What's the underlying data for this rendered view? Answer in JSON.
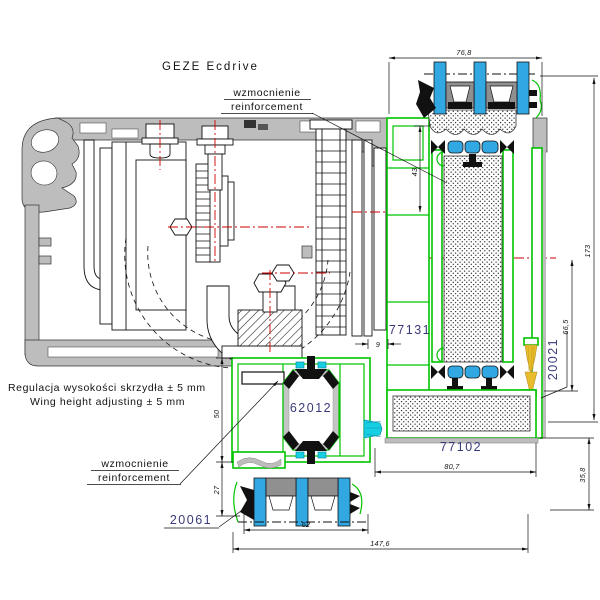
{
  "title": "GEZE Ecdrive",
  "annotations": {
    "reinforcement_top": {
      "pl": "wzmocnienie",
      "en": "reinforcement"
    },
    "reinforcement_bottom": {
      "pl": "wzmocnienie",
      "en": "reinforcement"
    },
    "wing_adjust": {
      "pl": "Regulacja wysokości skrzydła ± 5 mm",
      "en": "Wing height adjusting ± 5 mm"
    }
  },
  "part_numbers": {
    "frame_profile": "77131",
    "transom_profile": "62012",
    "sill_profile": "77102",
    "glazing_bead_bottom": "20061",
    "glazing_bead_side": "20021"
  },
  "dimensions": {
    "top_width": "76,8",
    "glass_inset": "43",
    "overall_height": "173",
    "rebate_height": "66,5",
    "gap": "9",
    "transom_height": "50",
    "bead_height": "27",
    "glazing_width": "62",
    "overall_width": "147,6",
    "sill_width": "80,7",
    "sill_height": "35,8"
  },
  "colors": {
    "profile_green": "#00c300",
    "glass_blue": "#31a8e2",
    "brush_cyan": "#17cfe3",
    "aluminum_gray": "#bdbdbd",
    "centerline_red": "#cc0000",
    "label_navy": "#3a3a7a",
    "brush_gold": "#e8bc2c"
  }
}
